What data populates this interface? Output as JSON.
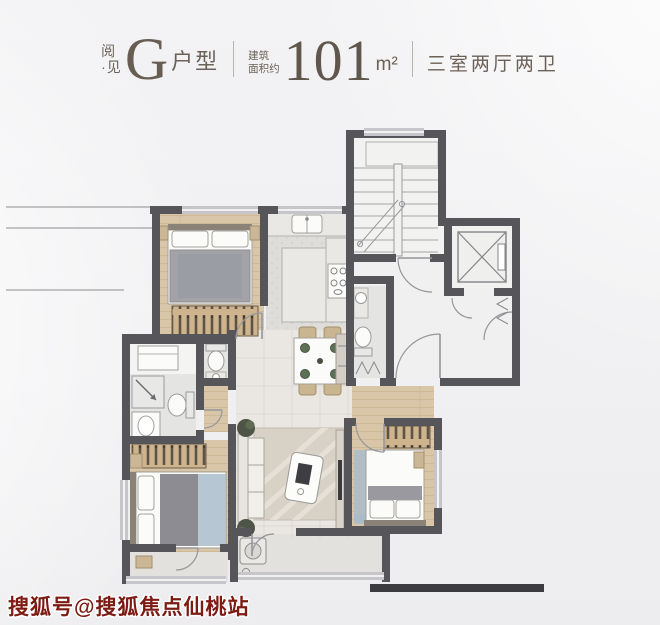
{
  "header": {
    "brand": {
      "line1": "阅",
      "line2": "·见"
    },
    "unit": {
      "letter": "G",
      "suffix": "户型"
    },
    "area": {
      "prefix_line1": "建筑",
      "prefix_line2": "面积约",
      "value": "101",
      "unit": "m²"
    },
    "layout": "三室两厅两卫"
  },
  "watermark": {
    "text": "搜狐号@搜狐焦点仙桃站",
    "color": "#7d1b13"
  },
  "colors": {
    "background": "#f1f1f3",
    "wall": "#55555a",
    "wood_floor": "#d9c6a8",
    "tile_floor": "#eae7e2",
    "header_text": "#6b6156",
    "watermark_red": "#7d1b13"
  },
  "floorplan": {
    "rooms": [
      "bedroom-top-left",
      "kitchen",
      "stairwell",
      "elevator",
      "entry-lobby",
      "guest-bathroom",
      "dining-room",
      "living-room",
      "bathroom-1",
      "bathroom-2",
      "utility",
      "master-bedroom",
      "bedroom-bottom-right",
      "hallway",
      "balcony-master",
      "balcony-living"
    ],
    "furniture_icons": [
      "bed",
      "pillows",
      "wardrobe",
      "nightstand",
      "kitchen-sink",
      "stove",
      "island-counter",
      "dining-table",
      "dining-chairs",
      "sideboard",
      "sofa",
      "rug",
      "coffee-table",
      "tv-console",
      "plants",
      "toilet",
      "wash-basin",
      "shower",
      "washing-machine",
      "stairs",
      "elevator-cab",
      "door-arc"
    ]
  }
}
